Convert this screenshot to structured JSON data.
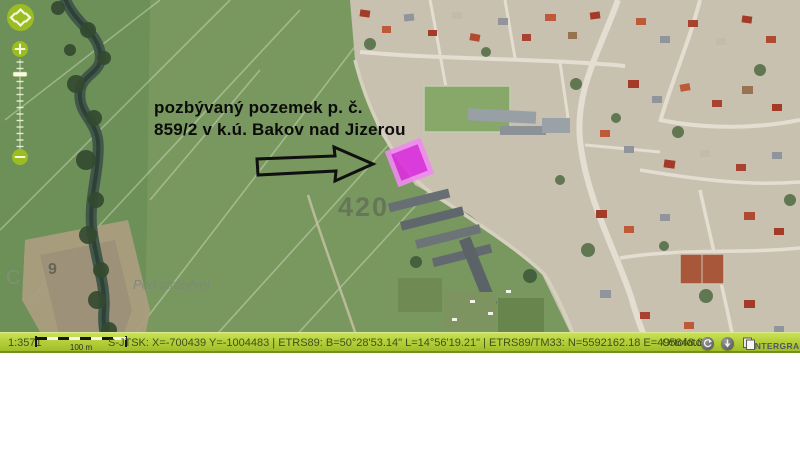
{
  "map": {
    "annotation": {
      "line1": "pozbývaný pozemek p. č.",
      "line2": "859/2 v k.ú. Bakov nad Jizerou"
    },
    "labels": {
      "parcel_number": "420",
      "place_name": "Pod stráněmi",
      "small_label_9": "9",
      "small_label_c": "C"
    },
    "highlight_color": "#dd2ee0"
  },
  "statusbar": {
    "scale": "1:3571",
    "scalebar_label": "100 m",
    "coordinates": "S-JTSK: X=-700439 Y=-1004483 | ETRS89: B=50°28'53.14\" L=14°56'19.21\" | ETRS89/TM33: N=5592162.18 E=495648.81",
    "layer": "Ortofoto",
    "logo": "INTERGRAPH"
  },
  "colors": {
    "statusbar_green": "#b5d03a",
    "control_green": "#9fc025",
    "parcel_magenta": "#dd2ee0",
    "parcel_border": "#ef8aef"
  }
}
